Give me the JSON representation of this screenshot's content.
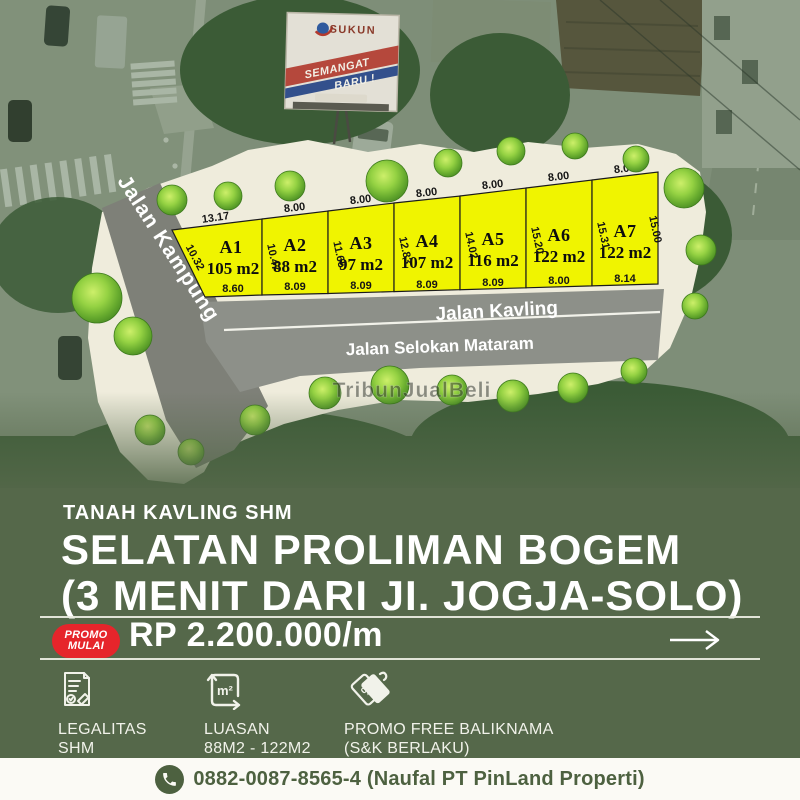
{
  "colors": {
    "olive_bg": "#55684a",
    "plot_yellow": "#f0f400",
    "badge_red": "#e6252b",
    "bar_bg": "#fbfaf5",
    "bar_text": "#4d6140",
    "plan_cream": "#efecdc",
    "road_gray": "#8d9089",
    "kampung_gray": "#7e8078"
  },
  "photo": {
    "billboard": {
      "brand": "SUKUN",
      "slogan_line1": "SEMANGAT",
      "slogan_line2": "BARU !"
    }
  },
  "siteplan": {
    "watermark": "TribunJualBeli",
    "roads": {
      "kampung": "Jalan Kampung",
      "kavling": "Jalan Kavling",
      "selokan": "Jalan Selokan Mataram"
    },
    "plots": [
      {
        "name": "A1",
        "area": "105 m2",
        "top_dim": "13.17",
        "side_dim": "10.32",
        "bottom_dim": "8.60"
      },
      {
        "name": "A2",
        "area": "88 m2",
        "top_dim": "8.00",
        "side_dim": "10.47",
        "bottom_dim": "8.09"
      },
      {
        "name": "A3",
        "area": "97 m2",
        "top_dim": "8.00",
        "side_dim": "11.65",
        "bottom_dim": "8.09"
      },
      {
        "name": "A4",
        "area": "107 m2",
        "top_dim": "8.00",
        "side_dim": "12.83",
        "bottom_dim": "8.09"
      },
      {
        "name": "A5",
        "area": "116 m2",
        "top_dim": "8.00",
        "side_dim": "14.02",
        "bottom_dim": "8.09"
      },
      {
        "name": "A6",
        "area": "122 m2",
        "top_dim": "8.00",
        "side_dim": "15.20",
        "bottom_dim": "8.00"
      },
      {
        "name": "A7",
        "area": "122 m2",
        "top_dim": "8.00",
        "side_dim": "15.31",
        "bottom_dim": "8.14",
        "right_dim": "15.00"
      }
    ]
  },
  "listing": {
    "kicker": "TANAH KAVLING SHM",
    "title_line1": "SELATAN PROLIMAN BOGEM",
    "title_line2": "(3 MENIT DARI JI. JOGJA-SOLO)",
    "badge": {
      "line1": "PROMO",
      "line2": "MULAI"
    },
    "price": "RP 2.200.000/m",
    "features": [
      {
        "icon": "legality-document-icon",
        "line1": "LEGALITAS",
        "line2": "SHM"
      },
      {
        "icon": "land-area-icon",
        "icon_glyph": "m²",
        "line1": "LUASAN",
        "line2": "88M2 - 122M2"
      },
      {
        "icon": "promo-tag-icon",
        "icon_glyph": "%",
        "line1": "PROMO FREE BALIKNAMA",
        "line2": "(S&K BERLAKU)"
      }
    ],
    "contact": {
      "phone_label": "0882-0087-8565-4 (Naufal PT PinLand Properti)"
    }
  }
}
